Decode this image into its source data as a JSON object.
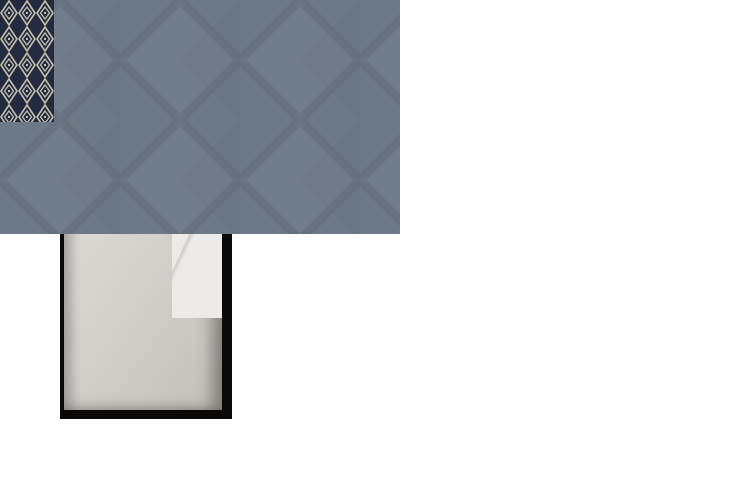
{
  "scene": {
    "kind": "3d-cutaway-top-down-render",
    "subject": "compact cabin interior: bathroom at left, bedroom with single bed at right",
    "rooms": [
      {
        "id": "bathroom",
        "objects": [
          "wood-slat-shower-screen",
          "wood-plank-ceiling",
          "marble-wall",
          "curved-white-vanity",
          "toilet",
          "green-tinted-mirror",
          "vanity-counter",
          "soap-dish",
          "towel-hook",
          "shower-grab-bar",
          "handheld-shower",
          "shower-handle-bar",
          "corner-shower-shelf",
          "floor-drain",
          "grey-shower-floor"
        ]
      },
      {
        "id": "entry",
        "objects": [
          "wood-entry-door",
          "ceiling-light-fixture",
          "door-lock-plate",
          "door-handle",
          "marble-closet-front",
          "wood-wardrobe-front",
          "closet-handle-slot"
        ]
      },
      {
        "id": "bedroom",
        "objects": [
          "diamond-pattern-carpet",
          "blue-accent-wall",
          "wall-niche",
          "framed-mirror-artwork",
          "single-bed-white-duvet",
          "geometric-navy-bed-runner",
          "stacked-white-pillows",
          "blue-wall-cabinet",
          "wood-cap-rail",
          "vanity-mirror-with-reflection",
          "wood-desk-surface",
          "grey-stool-with-orange-handle",
          "dark-glass-bench-top",
          "slatted-bench-top",
          "under-furniture-storage-compartments",
          "black-cutaway-walls"
        ]
      }
    ]
  },
  "palette": {
    "wall-black": "#0b0908",
    "marble": "#edebe8",
    "mirror-green": "#a9cbb4",
    "fixture-black": "#1b1917",
    "wood-ceiling": "#9a8066",
    "wood-door": "#8a7053",
    "wood-desk": "#a8885c",
    "bath-floor": "#8a8784",
    "carpet-base": "#6e7988",
    "carpet-dark": "#5a6372",
    "carpet-light": "#808a98",
    "wall-blue": "#7b96ba",
    "wall-blue-dark": "#4c5c77",
    "cabinet-blue": "#54719c",
    "bed-white": "#e9e5de",
    "runner-navy": "#222b40",
    "runner-line": "#c6bfae",
    "runner-trim": "#a39070",
    "pillow-trim": "#55504a",
    "compartment-glow": "#b8854e",
    "stool-grey": "#a79f93",
    "stool-handle": "#c1762e",
    "niche-cream": "#c9b795",
    "trim-beige": "#cfc4ae",
    "background": "#ffffff"
  }
}
